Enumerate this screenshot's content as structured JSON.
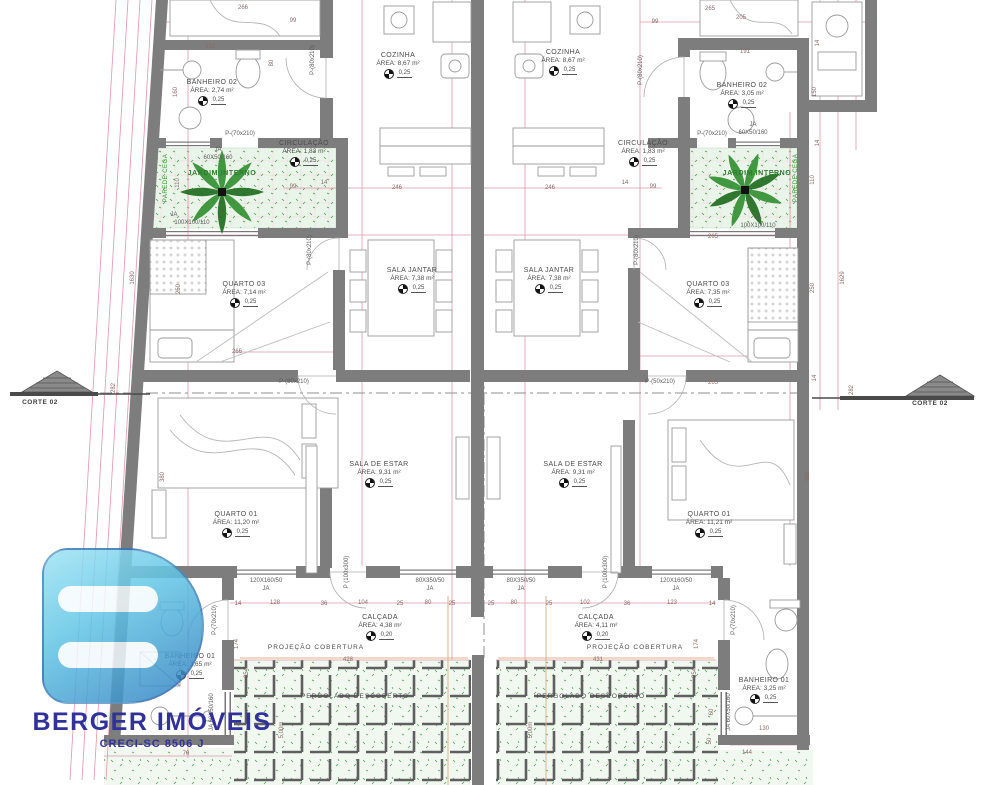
{
  "brand": {
    "name": "BERGER IMÓVEIS",
    "creci": "CRECI-SC 8506 J"
  },
  "units": {
    "left": {
      "banheiro02": {
        "name": "BANHEIRO 02",
        "area": "ÁREA: 2,74 m²",
        "coef": "0,25"
      },
      "cozinha": {
        "name": "COZINHA",
        "area": "ÁREA: 8,67 m²",
        "coef": "0,25"
      },
      "circulacao": {
        "name": "CIRCULAÇÃO",
        "area": "ÁREA: 1,83 m²",
        "coef": "0,25"
      },
      "jardim": {
        "name": "JARDIM INTERNO"
      },
      "quarto03": {
        "name": "QUARTO 03",
        "area": "ÁREA: 7,14 m²",
        "coef": "0,25"
      },
      "sala_jantar": {
        "name": "SALA JANTAR",
        "area": "ÁREA: 7,38 m²",
        "coef": "0,25"
      },
      "quarto01": {
        "name": "QUARTO 01",
        "area": "ÁREA: 11,20 m²",
        "coef": "0,25"
      },
      "sala_estar": {
        "name": "SALA DE ESTAR",
        "area": "ÁREA: 9,31 m²",
        "coef": "0,25"
      },
      "banheiro01": {
        "name": "BANHEIRO 01",
        "area": "ÁREA: 3,65 m²",
        "coef": "0,25"
      },
      "calcada": {
        "name": "CALÇADA",
        "area": "ÁREA: 4,38 m²",
        "coef": "0,20"
      },
      "projecao": {
        "name": "PROJEÇÃO COBERTURA"
      },
      "pergolado": {
        "name": "PERGOLADO DESCOBERTO"
      }
    },
    "right": {
      "banheiro02": {
        "name": "BANHEIRO 02",
        "area": "ÁREA: 3,05 m²",
        "coef": "0,25"
      },
      "cozinha": {
        "name": "COZINHA",
        "area": "ÁREA: 8,67 m²",
        "coef": "0,25"
      },
      "circulacao": {
        "name": "CIRCULAÇÃO",
        "area": "ÁREA: 1,83 m²",
        "coef": "0,25"
      },
      "jardim": {
        "name": "JARDIM INTERNO"
      },
      "quarto03": {
        "name": "QUARTO 03",
        "area": "ÁREA: 7,35 m²",
        "coef": "0,25"
      },
      "sala_jantar": {
        "name": "SALA JANTAR",
        "area": "ÁREA: 7,38 m²",
        "coef": "0,25"
      },
      "quarto01": {
        "name": "QUARTO 01",
        "area": "ÁREA: 11,21 m²",
        "coef": "0,25"
      },
      "sala_estar": {
        "name": "SALA DE ESTAR",
        "area": "ÁREA: 9,31 m²",
        "coef": "0,25"
      },
      "banheiro01": {
        "name": "BANHEIRO 01",
        "area": "ÁREA: 3,25 m²",
        "coef": "0,25"
      },
      "calcada": {
        "name": "CALÇADA",
        "area": "ÁREA: 4,11 m²",
        "coef": "0,20"
      },
      "projecao": {
        "name": "PROJEÇÃO COBERTURA"
      },
      "pergolado": {
        "name": "PERGOLADO DESCOBERTO"
      }
    }
  },
  "colors": {
    "wall": "#7d7d7d",
    "dimension_line": "#e296ab",
    "garden": "#eaf5ea",
    "plant": "#2f8f2f",
    "logo_blue": "#31319b"
  },
  "annotations": [
    {
      "t": "266",
      "x": 243,
      "y": 8
    },
    {
      "t": "99",
      "x": 293,
      "y": 21
    },
    {
      "t": "172",
      "x": 210,
      "y": 47
    },
    {
      "t": "80",
      "x": 272,
      "y": 63,
      "v": true
    },
    {
      "t": "160",
      "x": 176,
      "y": 92,
      "v": true
    },
    {
      "t": "110",
      "x": 178,
      "y": 183,
      "v": true
    },
    {
      "t": "250",
      "x": 179,
      "y": 289,
      "v": true
    },
    {
      "t": "1630",
      "x": 133,
      "y": 278,
      "v": true
    },
    {
      "t": "282",
      "x": 114,
      "y": 388,
      "v": true
    },
    {
      "t": "99",
      "x": 293,
      "y": 187
    },
    {
      "t": "14",
      "x": 324,
      "y": 183
    },
    {
      "t": "246",
      "x": 397,
      "y": 188
    },
    {
      "t": "246",
      "x": 550,
      "y": 188
    },
    {
      "t": "14",
      "x": 625,
      "y": 183
    },
    {
      "t": "99",
      "x": 653,
      "y": 187
    },
    {
      "t": "265",
      "x": 710,
      "y": 9
    },
    {
      "t": "99",
      "x": 655,
      "y": 22
    },
    {
      "t": "205",
      "x": 741,
      "y": 18
    },
    {
      "t": "191",
      "x": 745,
      "y": 52
    },
    {
      "t": "14",
      "x": 818,
      "y": 43,
      "v": true
    },
    {
      "t": "150",
      "x": 815,
      "y": 92,
      "v": true
    },
    {
      "t": "14",
      "x": 818,
      "y": 143,
      "v": true
    },
    {
      "t": "110",
      "x": 813,
      "y": 180,
      "v": true
    },
    {
      "t": "250",
      "x": 813,
      "y": 288,
      "v": true
    },
    {
      "t": "1629",
      "x": 843,
      "y": 278,
      "v": true
    },
    {
      "t": "14",
      "x": 815,
      "y": 378,
      "v": true
    },
    {
      "t": "282",
      "x": 852,
      "y": 390,
      "v": true
    },
    {
      "t": "266",
      "x": 237,
      "y": 352
    },
    {
      "t": "265",
      "x": 713,
      "y": 237
    },
    {
      "t": "265",
      "x": 713,
      "y": 383
    },
    {
      "t": "380",
      "x": 163,
      "y": 477,
      "v": true
    },
    {
      "t": "380",
      "x": 808,
      "y": 477,
      "v": true
    },
    {
      "t": "14",
      "x": 238,
      "y": 604
    },
    {
      "t": "128",
      "x": 275,
      "y": 603
    },
    {
      "t": "36",
      "x": 324,
      "y": 604
    },
    {
      "t": "104",
      "x": 363,
      "y": 603
    },
    {
      "t": "25",
      "x": 400,
      "y": 604
    },
    {
      "t": "80",
      "x": 428,
      "y": 603
    },
    {
      "t": "25",
      "x": 452,
      "y": 604
    },
    {
      "t": "25",
      "x": 491,
      "y": 604
    },
    {
      "t": "80",
      "x": 514,
      "y": 603
    },
    {
      "t": "25",
      "x": 549,
      "y": 604
    },
    {
      "t": "102",
      "x": 585,
      "y": 603
    },
    {
      "t": "36",
      "x": 627,
      "y": 604
    },
    {
      "t": "123",
      "x": 672,
      "y": 603
    },
    {
      "t": "14",
      "x": 712,
      "y": 604
    },
    {
      "t": "428",
      "x": 348,
      "y": 660
    },
    {
      "t": "431",
      "x": 598,
      "y": 660
    },
    {
      "t": "174",
      "x": 237,
      "y": 644,
      "v": true
    },
    {
      "t": "174",
      "x": 697,
      "y": 644,
      "v": true
    },
    {
      "t": "354",
      "x": 247,
      "y": 673,
      "v": true
    },
    {
      "t": "354",
      "x": 695,
      "y": 673,
      "v": true
    },
    {
      "t": "5,00m",
      "x": 282,
      "y": 730,
      "v": true
    },
    {
      "t": "5,00m",
      "x": 531,
      "y": 730,
      "v": true
    },
    {
      "t": "70",
      "x": 186,
      "y": 754
    },
    {
      "t": "130",
      "x": 764,
      "y": 729
    },
    {
      "t": "144",
      "x": 747,
      "y": 753
    },
    {
      "t": "60",
      "x": 712,
      "y": 712,
      "v": true
    },
    {
      "t": "50",
      "x": 710,
      "y": 741,
      "v": true
    },
    {
      "t": "P-(70x210)",
      "x": 240,
      "y": 134,
      "k": "open"
    },
    {
      "t": "P-(80x210)",
      "x": 313,
      "y": 60,
      "v": true,
      "k": "open"
    },
    {
      "t": "P-(80x210)",
      "x": 310,
      "y": 250,
      "v": true,
      "k": "open"
    },
    {
      "t": "P-(80x210)",
      "x": 294,
      "y": 382,
      "k": "open"
    },
    {
      "t": "P-(70x210)",
      "x": 712,
      "y": 134,
      "k": "open"
    },
    {
      "t": "P-(80x210)",
      "x": 641,
      "y": 70,
      "v": true,
      "k": "open"
    },
    {
      "t": "P-(80x210)",
      "x": 637,
      "y": 250,
      "v": true,
      "k": "open"
    },
    {
      "t": "P-(50x210)",
      "x": 660,
      "y": 382,
      "k": "open"
    },
    {
      "t": "P (100x300)",
      "x": 347,
      "y": 572,
      "v": true,
      "k": "open"
    },
    {
      "t": "P (100x300)",
      "x": 606,
      "y": 572,
      "v": true,
      "k": "open"
    },
    {
      "t": "P-(70x210)",
      "x": 215,
      "y": 620,
      "v": true,
      "k": "open"
    },
    {
      "t": "P-(70x210)",
      "x": 734,
      "y": 620,
      "v": true,
      "k": "open"
    },
    {
      "t": "JA",
      "x": 218,
      "y": 150,
      "k": "open"
    },
    {
      "t": "60X50/160",
      "x": 218,
      "y": 158,
      "k": "open"
    },
    {
      "t": "JA",
      "x": 753,
      "y": 125,
      "k": "open"
    },
    {
      "t": "60X50/160",
      "x": 753,
      "y": 133,
      "k": "open"
    },
    {
      "t": "JA",
      "x": 174,
      "y": 215,
      "k": "open"
    },
    {
      "t": "100X100/110",
      "x": 192,
      "y": 223,
      "k": "open"
    },
    {
      "t": "JA",
      "x": 758,
      "y": 218,
      "k": "open"
    },
    {
      "t": "100X100/110",
      "x": 758,
      "y": 226,
      "k": "open"
    },
    {
      "t": "120X160/50",
      "x": 266,
      "y": 581,
      "k": "open"
    },
    {
      "t": "JA",
      "x": 266,
      "y": 589,
      "k": "open"
    },
    {
      "t": "120X160/50",
      "x": 676,
      "y": 581,
      "k": "open"
    },
    {
      "t": "JA",
      "x": 676,
      "y": 589,
      "k": "open"
    },
    {
      "t": "80X350/50",
      "x": 430,
      "y": 581,
      "k": "open"
    },
    {
      "t": "JA",
      "x": 430,
      "y": 589,
      "k": "open"
    },
    {
      "t": "80X350/50",
      "x": 521,
      "y": 581,
      "k": "open"
    },
    {
      "t": "JA",
      "x": 521,
      "y": 589,
      "k": "open"
    },
    {
      "t": "JA 60X50/160",
      "x": 212,
      "y": 712,
      "v": true,
      "k": "open"
    },
    {
      "t": "JA 60X50/160",
      "x": 729,
      "y": 712,
      "v": true,
      "k": "open"
    },
    {
      "t": "PAREDE CEGA",
      "x": 166,
      "y": 178,
      "v": true,
      "k": "green"
    },
    {
      "t": "PAREDE CEGA",
      "x": 796,
      "y": 178,
      "v": true,
      "k": "green"
    },
    {
      "t": "CORTE 02",
      "x": 40,
      "y": 403,
      "k": "corte"
    },
    {
      "t": "CORTE 02",
      "x": 930,
      "y": 404,
      "k": "corte"
    }
  ]
}
